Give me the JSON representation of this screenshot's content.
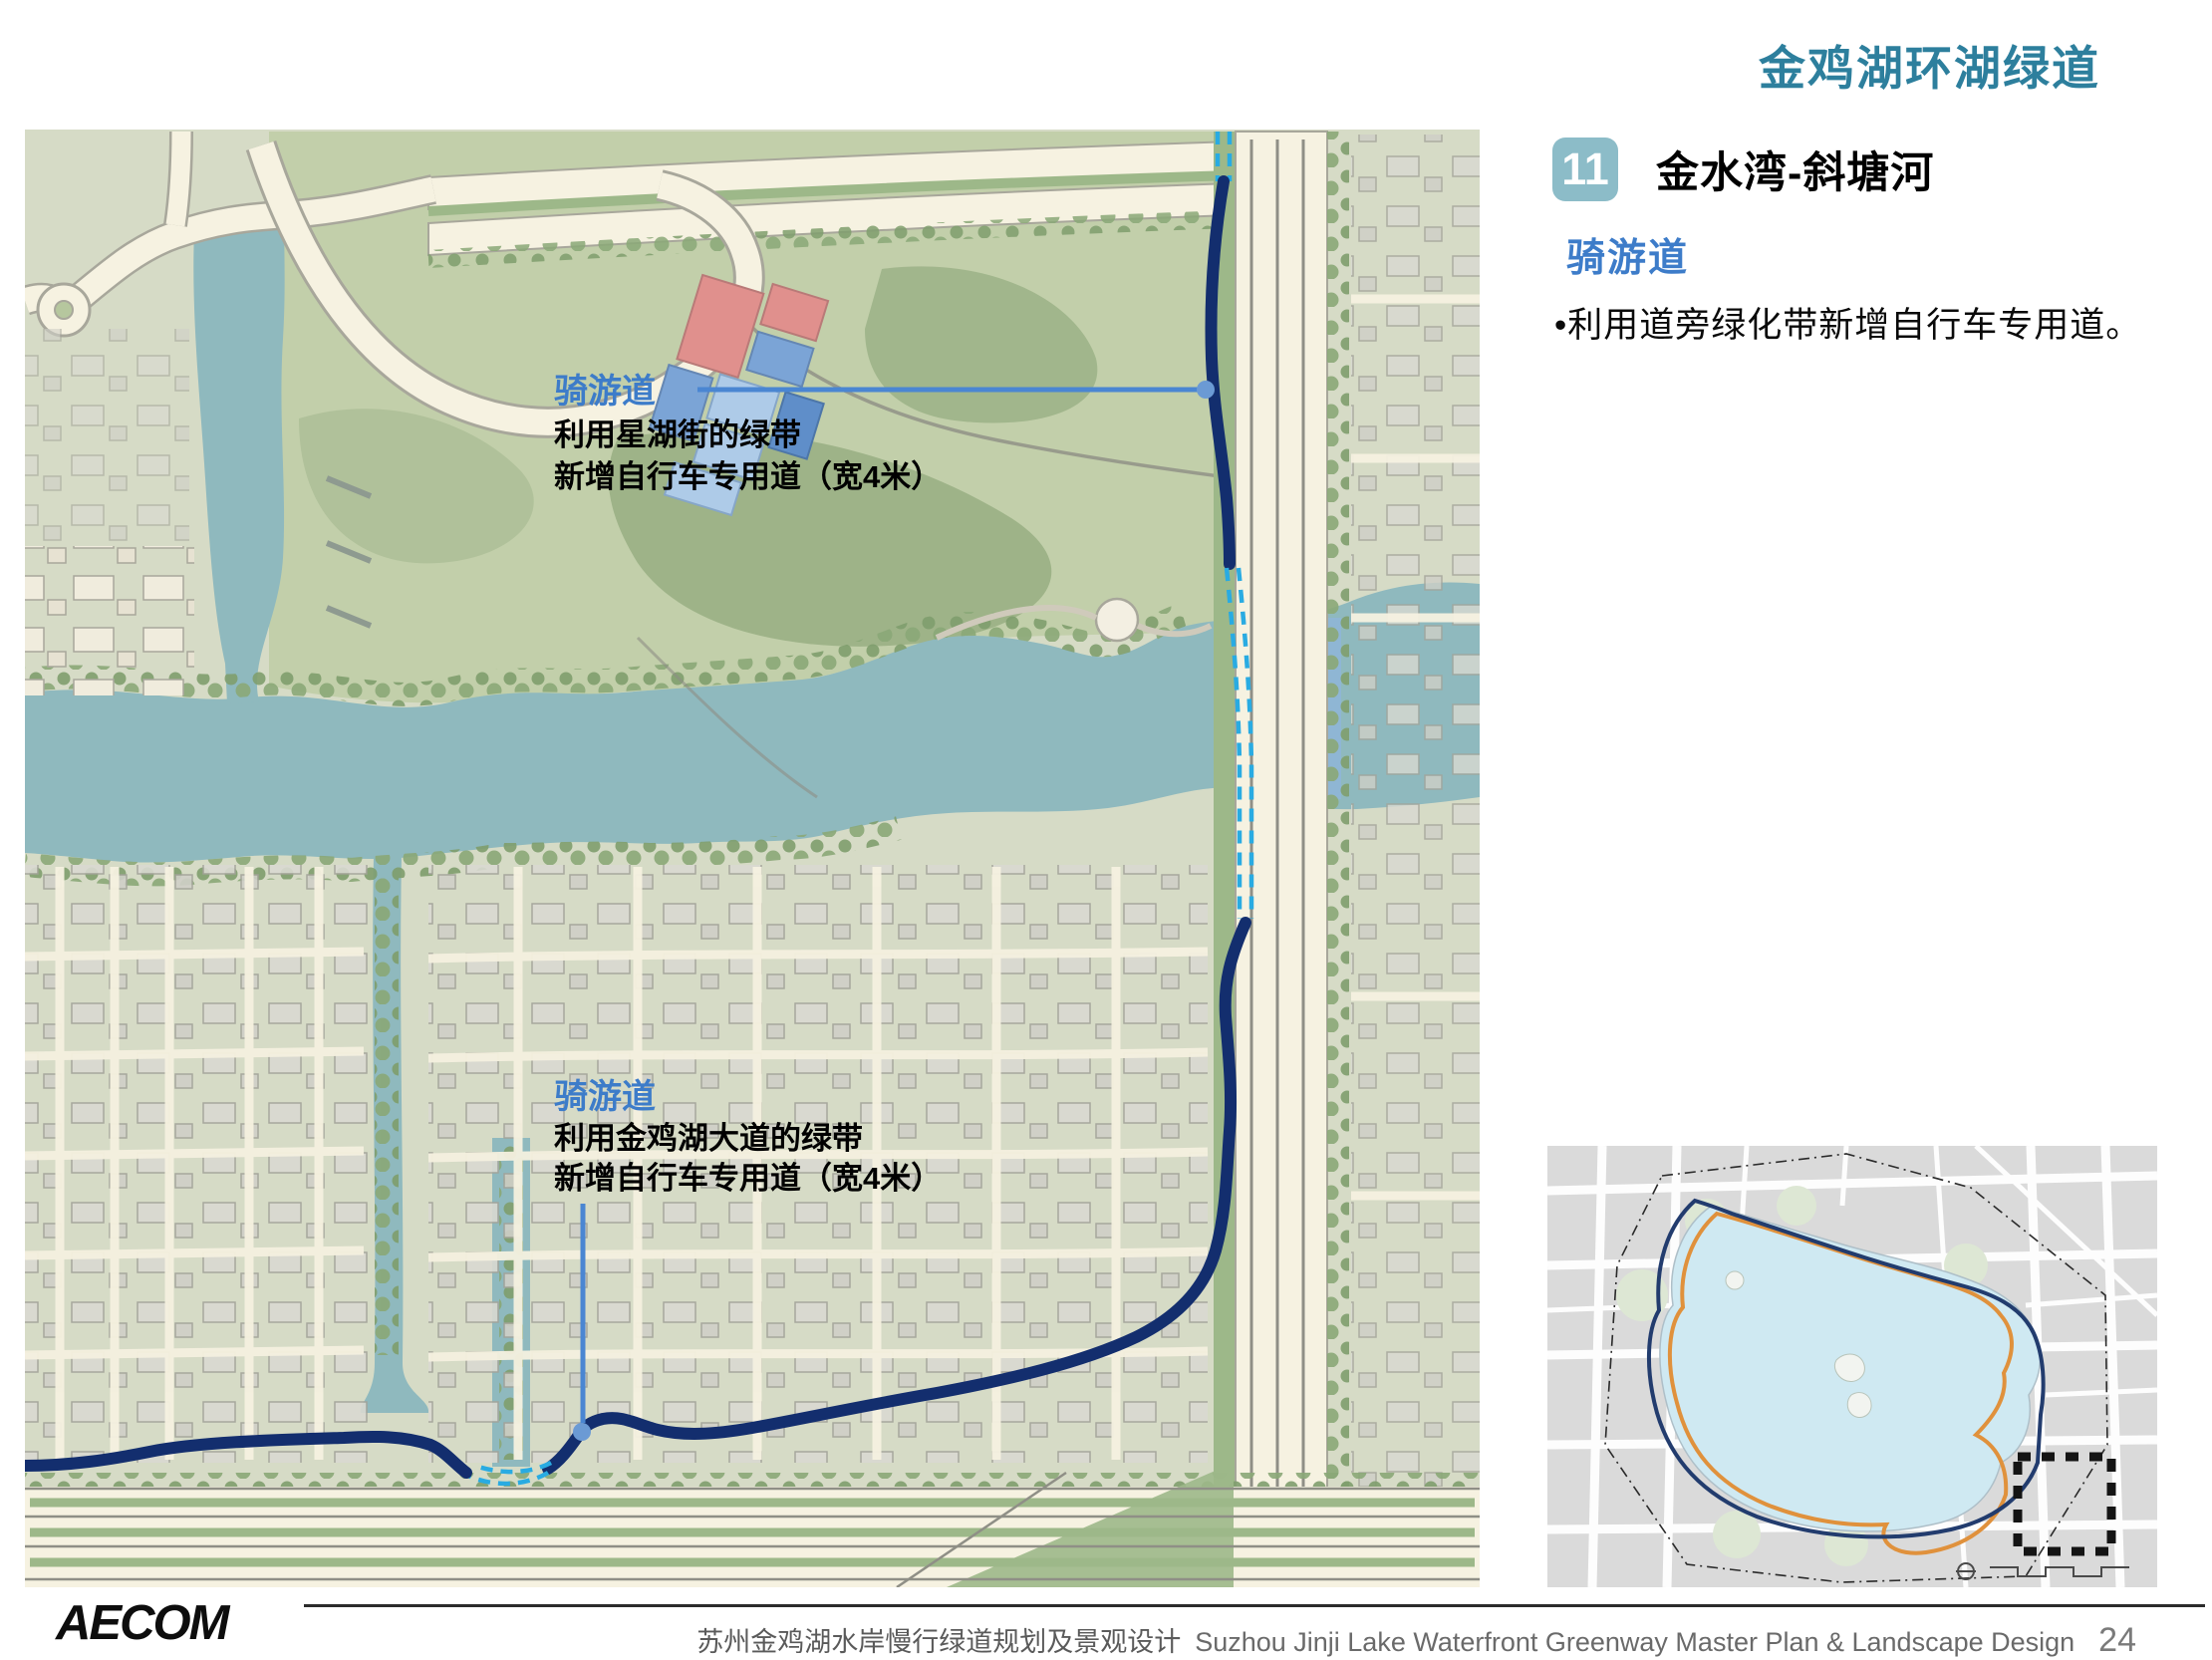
{
  "page": {
    "title": "金鸡湖环湖绿道"
  },
  "section": {
    "badge": "11",
    "title": "金水湾-斜塘河",
    "category_label": "骑游道",
    "bullets": [
      "•利用道旁绿化带新增自行车专用道。"
    ]
  },
  "map": {
    "annotations": [
      {
        "label": "骑游道",
        "lines": [
          "利用星湖街的绿带",
          "新增自行车专用道（宽4米）"
        ]
      },
      {
        "label": "骑游道",
        "lines": [
          "利用金鸡湖大道的绿带",
          "新增自行车专用道（宽4米）"
        ]
      }
    ]
  },
  "footer": {
    "logo": "AECOM",
    "title_cn": "苏州金鸡湖水岸慢行绿道规划及景观设计",
    "title_en": "Suzhou Jinji Lake Waterfront Greenway  Master Plan & Landscape Design",
    "page_number": "24"
  },
  "colors": {
    "title_teal": "#2d7f9d",
    "badge_teal": "#8cbcc8",
    "label_blue": "#3d7cc9",
    "route_navy": "#132e6e",
    "route_dashed_cyan": "#29abe2",
    "callout_blue": "#4a86d2",
    "river_teal": "#8fb9be",
    "inset_lake_blue": "#cfe9f2",
    "inset_route_orange": "#e0913c"
  }
}
